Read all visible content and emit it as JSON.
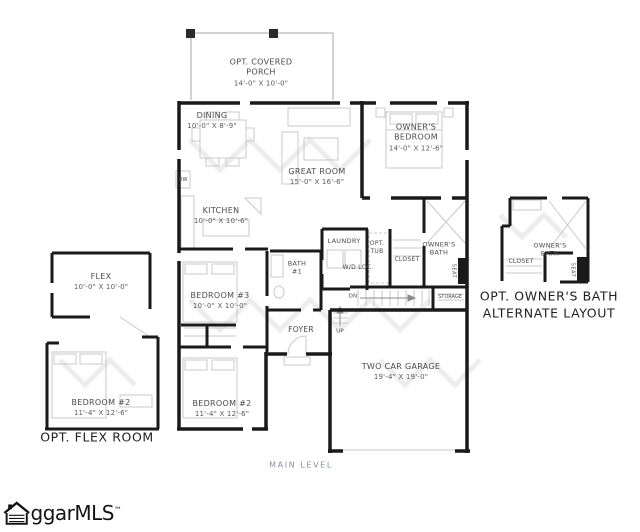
{
  "plan": {
    "level_label": "MAIN LEVEL",
    "rooms": {
      "porch": {
        "name": "OPT. COVERED PORCH",
        "dims": "14'-0\" X 10'-0\""
      },
      "dining": {
        "name": "DINING",
        "dims": "10'-0\" X 8'-9\""
      },
      "great_room": {
        "name": "GREAT ROOM",
        "dims": "15'-0\" X 16'-6\""
      },
      "owners_bedroom": {
        "name": "OWNER'S BEDROOM",
        "dims": "14'-0\" X 12'-6\""
      },
      "kitchen": {
        "name": "KITCHEN",
        "dims": "10'-0\" X 10'-6\""
      },
      "laundry": {
        "name": "LAUNDRY"
      },
      "opt_tub": {
        "name": "OPT. TUB"
      },
      "wd_loc": {
        "name": "W/D  LOC."
      },
      "owners_closet": {
        "name": "CLOSET"
      },
      "owners_bath": {
        "name": "OWNER'S BATH"
      },
      "seat": {
        "name": "SEAT"
      },
      "storage": {
        "name": "STORAGE"
      },
      "stairs_dn": {
        "name": "DN"
      },
      "stairs_up": {
        "name": "UP"
      },
      "foyer": {
        "name": "FOYER"
      },
      "bath1": {
        "name": "BATH #1"
      },
      "bedroom3": {
        "name": "BEDROOM #3",
        "dims": "10'-0\" X 10'-0\""
      },
      "bedroom2": {
        "name": "BEDROOM #2",
        "dims": "11'-4\" X 12'-6\""
      },
      "garage": {
        "name": "TWO CAR GARAGE",
        "dims": "19'-4\" X 19'-0\""
      },
      "dw": {
        "name": "DW"
      }
    },
    "flex_option": {
      "flex": {
        "name": "FLEX",
        "dims": "10'-0\" X 10'-0\""
      },
      "bedroom2": {
        "name": "BEDROOM #2",
        "dims": "11'-4\" X 12'-6\""
      },
      "caption": "OPT. FLEX ROOM"
    },
    "bath_option": {
      "owners_bath": "OWNER'S BATH",
      "closet": "CLOSET",
      "seat": "SEAT",
      "caption_line1": "OPT. OWNER'S BATH",
      "caption_line2": "ALTERNATE LAYOUT"
    }
  },
  "watermark": {
    "brand": "ggarMLS",
    "tm": "™"
  },
  "colors": {
    "wall": "#1a1a1a",
    "fixture": "#c9c9c9",
    "label": "#4a4a4a",
    "level_label": "#8492a4"
  }
}
